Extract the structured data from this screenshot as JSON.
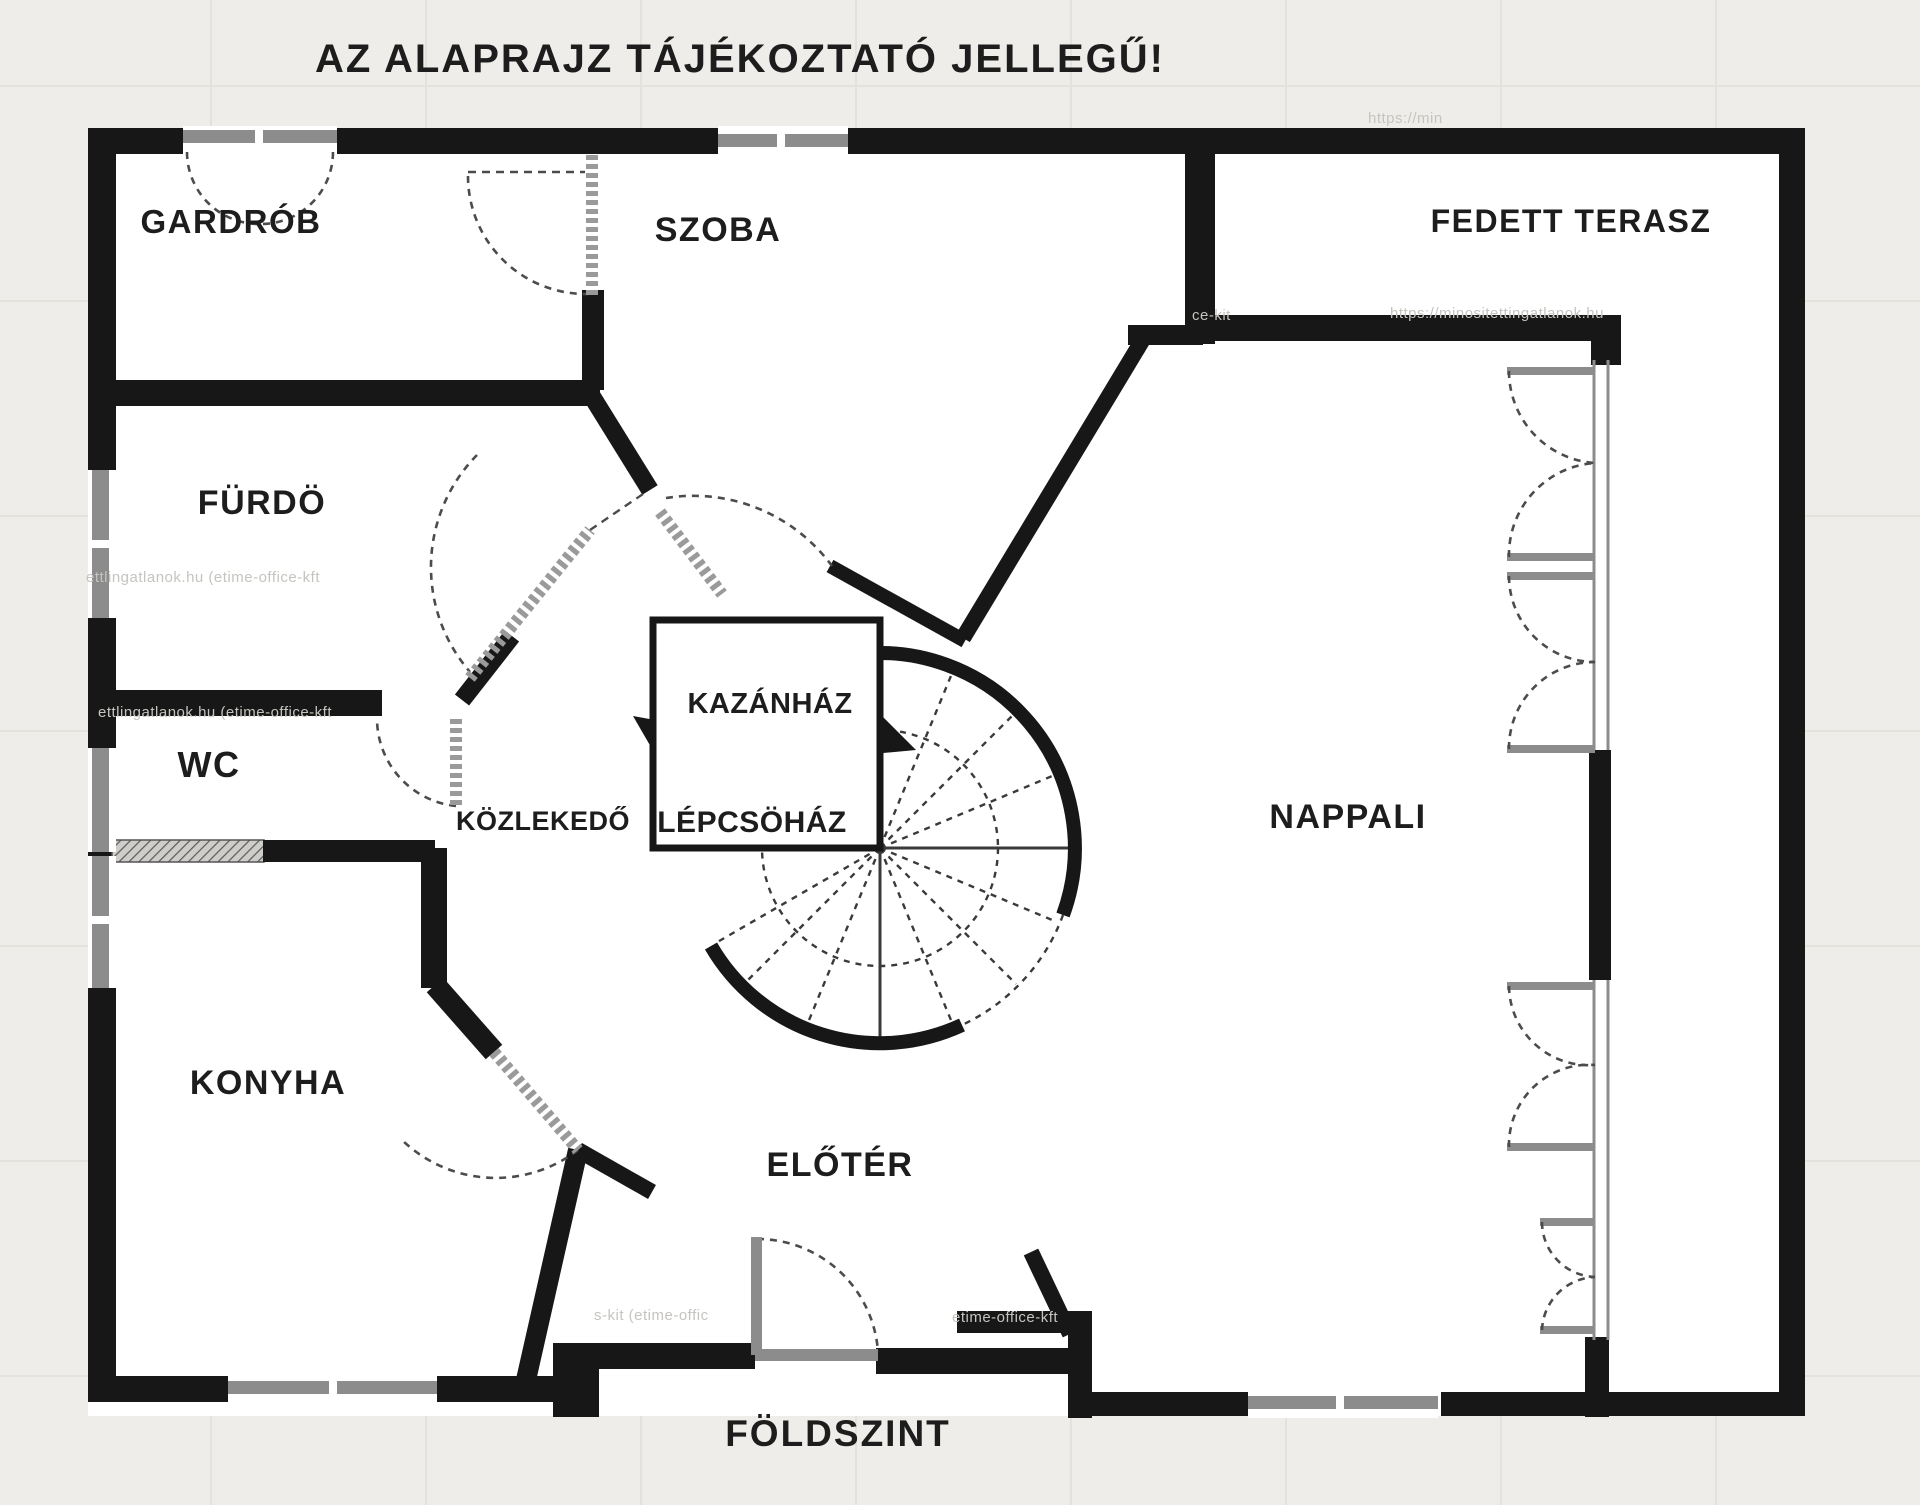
{
  "title": "AZ ALAPRAJZ TÁJÉKOZTATÓ JELLEGŰ!",
  "floor_plan": {
    "rooms": {
      "gardrob": "GARDRÓB",
      "szoba": "SZOBA",
      "fedett_terasz": "FEDETT TERASZ",
      "furdo": "FÜRDÖ",
      "wc": "WC",
      "kozlekedo": "KÖZLEKEDŐ",
      "kazanhaz": "KAZÁNHÁZ",
      "lepcsohaz": "LÉPCSÖHÁZ",
      "nappali": "NAPPALI",
      "konyha": "KONYHA",
      "eloter": "ELŐTÉR"
    },
    "floor_label": "FÖLDSZINT"
  },
  "watermarks": {
    "wm1": "https://min",
    "wm2": "ce-kit",
    "wm3": "https://minositettingatlanok.hu",
    "wm4": "ettlingatlanok.hu (etime-office-kft",
    "wm5": "ettlingatlanok.hu (etime-office-kft",
    "wm6": "s-kit (etime-offic",
    "wm7": "etime-office-kft"
  },
  "colors": {
    "wall": "#171717",
    "background": "#efede9",
    "paper": "#ffffff",
    "window-frame": "#8c8c8c",
    "door-leaf": "#9a9a9a",
    "door-arc": "#4c4c4c",
    "ink": "#1d1d1d",
    "watermark": "#c6c4bf",
    "grid": "#e4e2dc"
  }
}
